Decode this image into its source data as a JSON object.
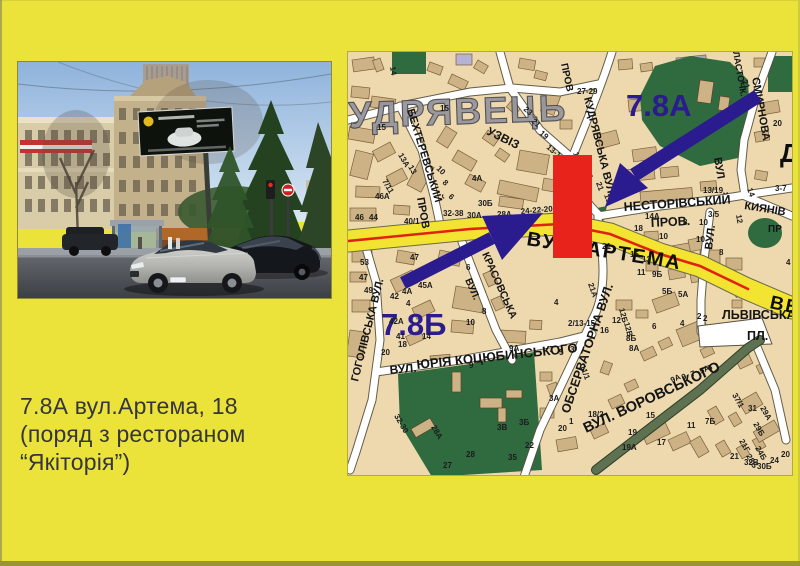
{
  "slide": {
    "caption": {
      "line1": "7.8А вул.Артема, 18",
      "line2": "(поряд з рестораном",
      "line3": "“Якіторія”)"
    }
  },
  "colors": {
    "background": "#ebe339",
    "marker_red": "#e8231b",
    "arrow_blue": "#2a1b8f",
    "road_yellow": "#f2e430",
    "map_base": "#eed9af",
    "park_green": "#2f6b3f"
  },
  "map": {
    "district_label": "УДРЯВЕЦЬ",
    "marker_a": "7.8А",
    "marker_b": "7.8Б",
    "streets": [
      {
        "t": "УДРЯВЕЦЬ",
        "x": 349,
        "y": 128,
        "r": -2,
        "s": 37,
        "c": "district"
      },
      {
        "t": "БЕХТЕРЕВСЬКИЙ",
        "x": 407,
        "y": 110,
        "r": 73,
        "s": 11,
        "c": "st"
      },
      {
        "t": "ПРОВ",
        "x": 417,
        "y": 198,
        "r": 80,
        "s": 11,
        "c": "st"
      },
      {
        "t": "УЗВІЗ",
        "x": 486,
        "y": 134,
        "r": 26,
        "s": 12,
        "c": "st"
      },
      {
        "t": "ПРОВ",
        "x": 561,
        "y": 64,
        "r": 78,
        "s": 10,
        "c": "st"
      },
      {
        "t": "КУДРЯВСЬКА ВУЛ.",
        "x": 584,
        "y": 98,
        "r": 76,
        "s": 11,
        "c": "st"
      },
      {
        "t": "ЛАСТОЧК.",
        "x": 733,
        "y": 52,
        "r": 80,
        "s": 9,
        "c": "st"
      },
      {
        "t": "СМИРНОВА",
        "x": 752,
        "y": 78,
        "r": 80,
        "s": 11,
        "c": "st"
      },
      {
        "t": "ВУЛ",
        "x": 714,
        "y": 158,
        "r": 80,
        "s": 11,
        "c": "st"
      },
      {
        "t": "НЕСТОРІВСЬКИЙ",
        "x": 624,
        "y": 211,
        "r": -4,
        "s": 12.5,
        "c": "st"
      },
      {
        "t": "ПРОВ.",
        "x": 651,
        "y": 227,
        "r": -3,
        "s": 12.5,
        "c": "st"
      },
      {
        "t": "КИЯНІВ",
        "x": 744,
        "y": 209,
        "r": 9,
        "s": 11,
        "c": "st"
      },
      {
        "t": "ВУЛ.",
        "x": 712,
        "y": 250,
        "r": -83,
        "s": 11,
        "c": "st"
      },
      {
        "t": "ВУЛ.  АРТЕМА",
        "x": 526,
        "y": 245,
        "r": 9,
        "s": 20,
        "c": "big"
      },
      {
        "t": "ВВ",
        "x": 769,
        "y": 308,
        "r": 12,
        "s": 19,
        "c": "big"
      },
      {
        "t": "ЛЬВІВСЬКА",
        "x": 722,
        "y": 319,
        "r": 0,
        "s": 12.5,
        "c": "st"
      },
      {
        "t": "ПЛ.",
        "x": 747,
        "y": 340,
        "r": 0,
        "s": 12.5,
        "c": "st"
      },
      {
        "t": "ВУЛ. ВОРОВСЬКОГО",
        "x": 586,
        "y": 433,
        "r": -25,
        "s": 14.5,
        "c": "st"
      },
      {
        "t": "ОБСЕРВАТОРНА ВУЛ.",
        "x": 569,
        "y": 414,
        "r": -71,
        "s": 12.5,
        "c": "st"
      },
      {
        "t": "ВУЛ.",
        "x": 390,
        "y": 374,
        "r": -5,
        "s": 12,
        "c": "st"
      },
      {
        "t": "ЮРІЯ КОЦЮБИНСЬКОГО",
        "x": 417,
        "y": 369,
        "r": -6,
        "s": 13,
        "c": "st"
      },
      {
        "t": "ГОГОЛІВСЬКА ВУЛ.",
        "x": 358,
        "y": 382,
        "r": -76,
        "s": 11,
        "c": "st"
      },
      {
        "t": "КРАСОВСЬКА",
        "x": 482,
        "y": 254,
        "r": 66,
        "s": 10.5,
        "c": "st"
      },
      {
        "t": "ВУЛ.",
        "x": 465,
        "y": 280,
        "r": 66,
        "s": 10,
        "c": "st"
      },
      {
        "t": "ПР",
        "x": 768,
        "y": 232,
        "r": 0,
        "s": 10,
        "c": "st"
      },
      {
        "t": "Д",
        "x": 780,
        "y": 162,
        "r": 0,
        "s": 26,
        "c": "big"
      },
      {
        "t": "7.8А",
        "x": 626,
        "y": 116,
        "r": 0,
        "s": 31,
        "c": "marker"
      },
      {
        "t": "7.8Б",
        "x": 381,
        "y": 335,
        "r": 0,
        "s": 31,
        "c": "marker"
      }
    ],
    "numbers": [
      [
        390,
        67,
        "14",
        80
      ],
      [
        440,
        111,
        "15",
        0
      ],
      [
        377,
        130,
        "15",
        0
      ],
      [
        398,
        155,
        "13А",
        60
      ],
      [
        408,
        167,
        "13",
        60
      ],
      [
        382,
        181,
        "7/11",
        60
      ],
      [
        436,
        169,
        "10",
        45
      ],
      [
        442,
        183,
        "8",
        45
      ],
      [
        448,
        197,
        "6",
        45
      ],
      [
        472,
        181,
        "4А",
        0
      ],
      [
        375,
        199,
        "46А",
        0
      ],
      [
        355,
        220,
        "46",
        0
      ],
      [
        369,
        220,
        "44",
        0
      ],
      [
        404,
        224,
        "40/1",
        0
      ],
      [
        443,
        216,
        "32-38",
        0
      ],
      [
        467,
        218,
        "30А",
        0
      ],
      [
        478,
        206,
        "30Б",
        0
      ],
      [
        497,
        217,
        "28А",
        0
      ],
      [
        521,
        214,
        "24-22-20",
        -5
      ],
      [
        523,
        110,
        "23",
        40
      ],
      [
        531,
        122,
        "21",
        40
      ],
      [
        539,
        134,
        "19",
        40
      ],
      [
        546,
        148,
        "13-19",
        40
      ],
      [
        573,
        153,
        "16",
        70
      ],
      [
        579,
        165,
        "14",
        70
      ],
      [
        577,
        94,
        "27-29",
        0
      ],
      [
        585,
        171,
        "23",
        70
      ],
      [
        596,
        183,
        "21",
        70
      ],
      [
        604,
        195,
        "19",
        70
      ],
      [
        742,
        81,
        "21",
        70
      ],
      [
        773,
        126,
        "20",
        0
      ],
      [
        747,
        189,
        "14",
        70
      ],
      [
        775,
        191,
        "3-7",
        0
      ],
      [
        703,
        193,
        "13/19",
        0
      ],
      [
        736,
        215,
        "12",
        80
      ],
      [
        708,
        217,
        "3/5",
        0
      ],
      [
        699,
        225,
        "10",
        0
      ],
      [
        696,
        242,
        "10",
        0
      ],
      [
        719,
        255,
        "8",
        0
      ],
      [
        786,
        265,
        "4",
        0
      ],
      [
        703,
        321,
        "2",
        0
      ],
      [
        645,
        219,
        "14А",
        0
      ],
      [
        634,
        231,
        "18",
        0
      ],
      [
        659,
        239,
        "10",
        0
      ],
      [
        683,
        225,
        "8",
        0
      ],
      [
        602,
        249,
        "21",
        0
      ],
      [
        588,
        284,
        "21А",
        70
      ],
      [
        630,
        257,
        "15",
        0
      ],
      [
        642,
        262,
        "13",
        0
      ],
      [
        637,
        275,
        "11",
        0
      ],
      [
        652,
        277,
        "9Б",
        0
      ],
      [
        662,
        294,
        "5Б",
        0
      ],
      [
        678,
        297,
        "5А",
        0
      ],
      [
        600,
        333,
        "16",
        0
      ],
      [
        612,
        323,
        "12",
        0
      ],
      [
        626,
        341,
        "8Б",
        0
      ],
      [
        629,
        351,
        "8А",
        0
      ],
      [
        652,
        329,
        "6",
        0
      ],
      [
        680,
        326,
        "4",
        0
      ],
      [
        697,
        319,
        "2",
        0
      ],
      [
        619,
        309,
        "12Б",
        75
      ],
      [
        624,
        323,
        "12В",
        75
      ],
      [
        672,
        383,
        "9А",
        -25
      ],
      [
        683,
        380,
        "9",
        -25
      ],
      [
        692,
        377,
        "7",
        -25
      ],
      [
        701,
        374,
        "5А",
        -25
      ],
      [
        709,
        371,
        "5",
        -25
      ],
      [
        628,
        435,
        "19",
        0
      ],
      [
        646,
        418,
        "15",
        0
      ],
      [
        622,
        450,
        "19А",
        0
      ],
      [
        657,
        445,
        "17",
        0
      ],
      [
        687,
        428,
        "11",
        0
      ],
      [
        705,
        424,
        "7Б",
        0
      ],
      [
        732,
        395,
        "37/1",
        60
      ],
      [
        748,
        411,
        "31",
        0
      ],
      [
        760,
        408,
        "29А",
        60
      ],
      [
        753,
        424,
        "29Б",
        60
      ],
      [
        739,
        441,
        "21Г",
        60
      ],
      [
        755,
        448,
        "24Б",
        60
      ],
      [
        746,
        456,
        "28Б",
        60
      ],
      [
        730,
        459,
        "21",
        0
      ],
      [
        744,
        465,
        "32В",
        0
      ],
      [
        757,
        469,
        "30Б",
        0
      ],
      [
        770,
        463,
        "24",
        0
      ],
      [
        781,
        457,
        "20",
        0
      ],
      [
        568,
        326,
        "2/13-15",
        0
      ],
      [
        580,
        366,
        "11/1",
        70
      ],
      [
        549,
        352,
        "7",
        0
      ],
      [
        559,
        355,
        "5",
        0
      ],
      [
        570,
        352,
        "3",
        0
      ],
      [
        509,
        351,
        "9А",
        0
      ],
      [
        469,
        368,
        "9",
        0
      ],
      [
        549,
        401,
        "3А",
        0
      ],
      [
        519,
        425,
        "3Б",
        0
      ],
      [
        497,
        430,
        "3В",
        0
      ],
      [
        525,
        448,
        "22",
        0
      ],
      [
        558,
        431,
        "20",
        0
      ],
      [
        569,
        424,
        "1",
        0
      ],
      [
        588,
        417,
        "18/2",
        0
      ],
      [
        554,
        305,
        "4",
        0
      ],
      [
        466,
        325,
        "10",
        0
      ],
      [
        466,
        270,
        "6",
        0
      ],
      [
        482,
        314,
        "8",
        0
      ],
      [
        402,
        294,
        "4А",
        0
      ],
      [
        406,
        306,
        "4",
        0
      ],
      [
        418,
        288,
        "45А",
        0
      ],
      [
        410,
        260,
        "47",
        0
      ],
      [
        360,
        265,
        "53",
        0
      ],
      [
        359,
        280,
        "47",
        0
      ],
      [
        364,
        293,
        "49",
        0
      ],
      [
        390,
        299,
        "42",
        0
      ],
      [
        389,
        324,
        "42А",
        0
      ],
      [
        396,
        339,
        "41",
        0
      ],
      [
        422,
        339,
        "14",
        0
      ],
      [
        398,
        347,
        "18",
        0
      ],
      [
        381,
        355,
        "20",
        0
      ],
      [
        431,
        427,
        "28А",
        60
      ],
      [
        394,
        416,
        "32-30",
        60
      ],
      [
        508,
        460,
        "35",
        0
      ],
      [
        466,
        457,
        "28",
        0
      ],
      [
        443,
        468,
        "27",
        0
      ]
    ]
  }
}
